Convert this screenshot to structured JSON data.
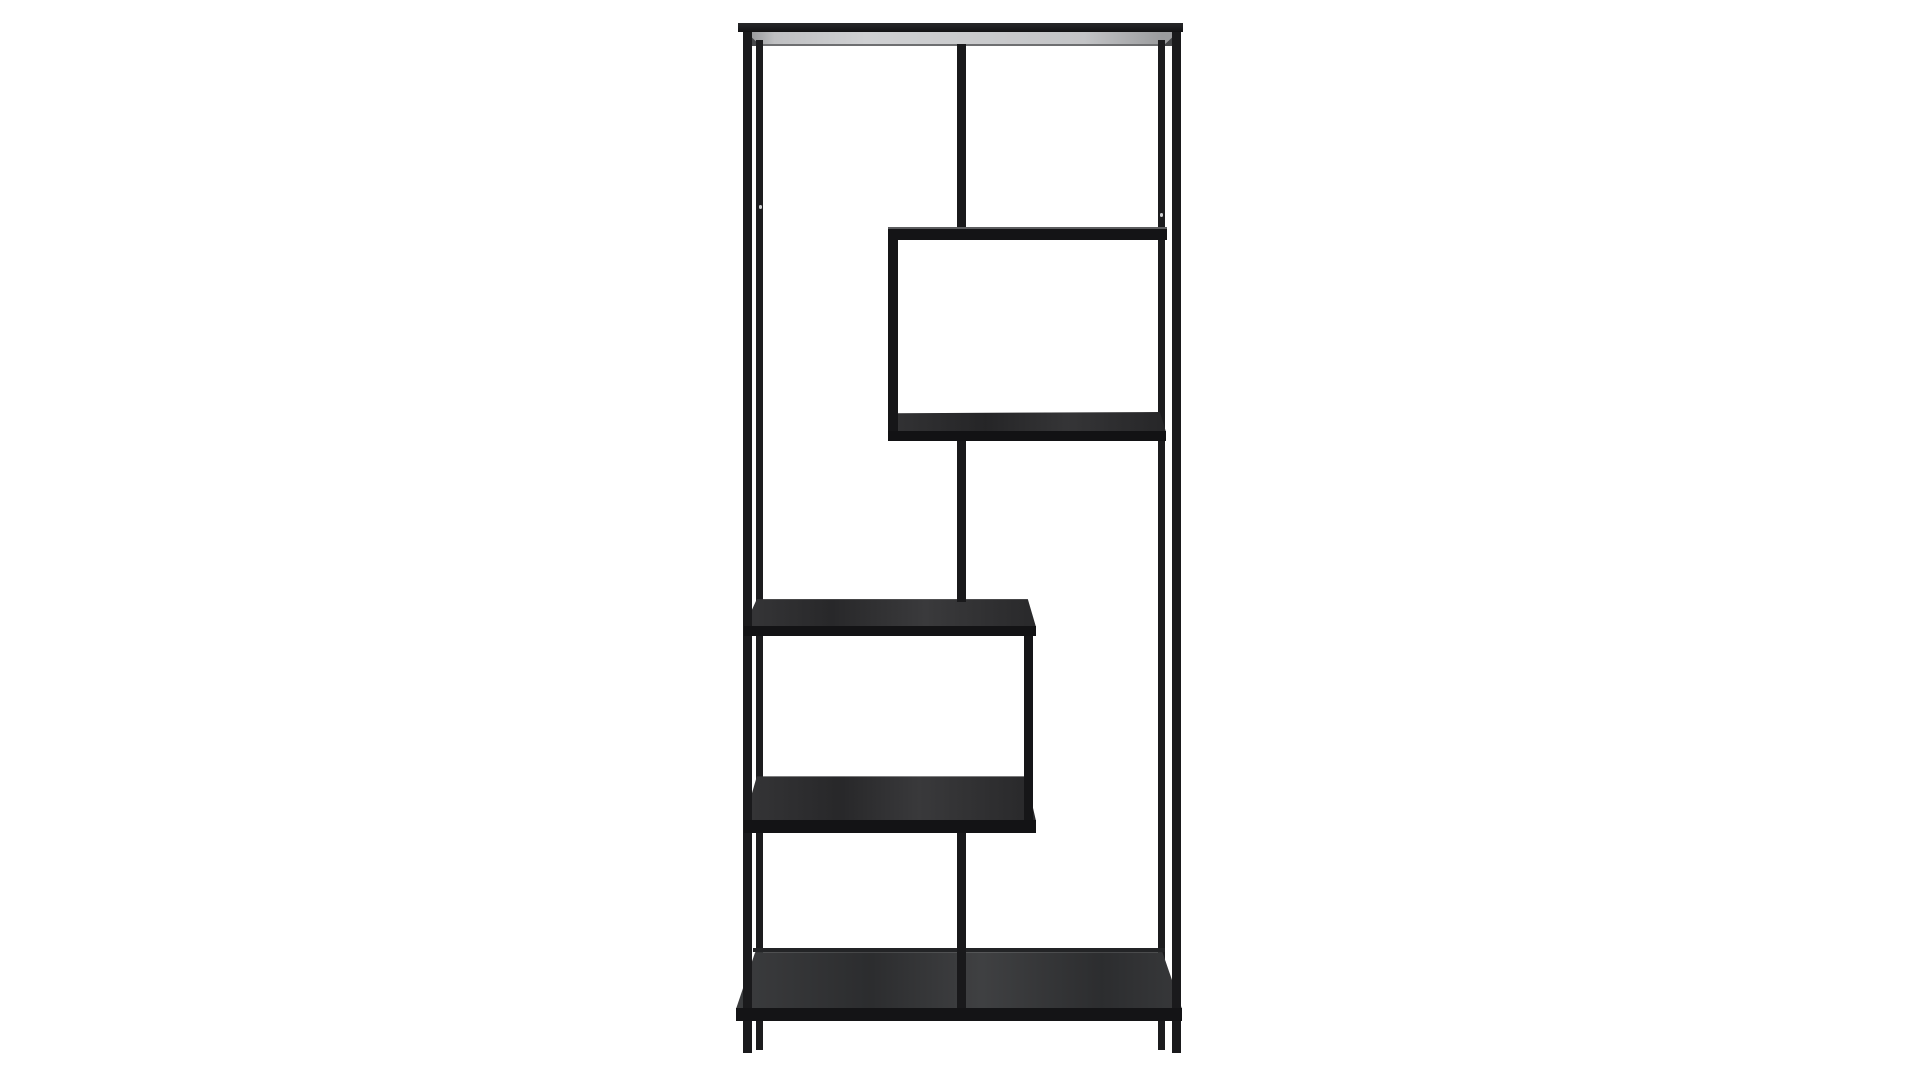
{
  "scene": {
    "description": "Product photo of a tall black metal asymmetric etagere bookcase with zig-zag open shelves, centered on a plain white studio background",
    "object": "asymmetric-metal-bookcase",
    "canvas": {
      "width": 1920,
      "height": 1080,
      "background": "#ffffff"
    },
    "palette": {
      "frame_metal": "#1a1a1c",
      "shelf_wood_top": "#2b2b2d",
      "top_shelf_underside": "#c9cacc",
      "background": "#ffffff"
    },
    "elements": [
      {
        "name": "top-shelf-underside",
        "x": 744,
        "y": 32,
        "w": 436,
        "h": 14,
        "bg": "linear-gradient(90deg,#8f9092 0%,#bfc0c2 7%,#cfd0d2 28%,#c9cacc 55%,#c3c4c6 78%,#9b9c9e 96%)",
        "clip": "polygon(0% 0%,100% 0%,96.3% 100%,3.2% 100%)"
      },
      {
        "name": "top-shelf-back-bar-line",
        "x": 757,
        "y": 44,
        "w": 408,
        "h": 2,
        "bg": "#6e6f71"
      },
      {
        "name": "top-shelf-left-corner-wedge",
        "x": 746,
        "y": 32,
        "w": 15,
        "h": 14,
        "bg": "#47484a",
        "clip": "polygon(0% 0%,100% 100%,0% 100%)"
      },
      {
        "name": "top-shelf-right-corner-wedge",
        "x": 1163,
        "y": 32,
        "w": 15,
        "h": 14,
        "bg": "#47484a",
        "clip": "polygon(100% 0%,100% 100%,0% 100%)"
      },
      {
        "name": "back-left-post",
        "x": 756,
        "y": 40,
        "w": 7,
        "h": 1010,
        "bg": "#1c1c1e"
      },
      {
        "name": "back-right-post",
        "x": 1158,
        "y": 40,
        "w": 7,
        "h": 1010,
        "bg": "#1c1c1e"
      },
      {
        "name": "box-bottom-shelf-surface",
        "x": 888,
        "y": 412,
        "w": 278,
        "h": 20,
        "bg": "linear-gradient(90deg,rgba(255,255,255,0.05),rgba(0,0,0,0.07) 35%,rgba(255,255,255,0.06) 65%,rgba(0,0,0,0.05)) #28282a",
        "clip": "polygon(2.5% 6%,97.8% 0%,100% 100%,0% 100%)"
      },
      {
        "name": "middle-left-shelf-surface",
        "x": 744,
        "y": 598,
        "w": 292,
        "h": 29,
        "bg": "linear-gradient(90deg,rgba(255,255,255,0.05),rgba(0,0,0,0.07) 30%,rgba(255,255,255,0.07) 62%,rgba(0,0,0,0.05)) #2b2b2d",
        "clip": "polygon(4.4% 4%,97.2% 4%,100% 100%,0% 100%)"
      },
      {
        "name": "lower-left-shelf-surface",
        "x": 744,
        "y": 775,
        "w": 292,
        "h": 46,
        "bg": "linear-gradient(90deg,rgba(255,255,255,0.05),rgba(0,0,0,0.06) 33%,rgba(255,255,255,0.07) 60%,rgba(0,0,0,0.05)) #2a2a2c",
        "clip": "polygon(4.4% 3%,96.5% 3%,100% 100%,0% 100%)"
      },
      {
        "name": "bottom-shelf-back-bar-line",
        "x": 753,
        "y": 948,
        "w": 412,
        "h": 4,
        "bg": "#232426"
      },
      {
        "name": "bottom-shelf-surface",
        "x": 736,
        "y": 951,
        "w": 446,
        "h": 58,
        "bg": "linear-gradient(90deg,rgba(255,255,255,0.06),rgba(0,0,0,0.07) 30%,rgba(255,255,255,0.08) 55%,rgba(0,0,0,0.06) 82%,rgba(255,255,255,0.04)) #2f3032",
        "clip": "polygon(4.3% 2%,95.6% 2%,100% 100%,0% 100%)"
      },
      {
        "name": "front-left-post",
        "x": 743,
        "y": 23,
        "w": 9,
        "h": 1030,
        "bg": "#1a1a1c"
      },
      {
        "name": "front-right-post",
        "x": 1172,
        "y": 23,
        "w": 9,
        "h": 1030,
        "bg": "#1a1a1c"
      },
      {
        "name": "center-divider-upper",
        "x": 957,
        "y": 44,
        "w": 9,
        "h": 186,
        "bg": "#19191b"
      },
      {
        "name": "center-divider-middle",
        "x": 957,
        "y": 438,
        "w": 9,
        "h": 164,
        "bg": "#19191b"
      },
      {
        "name": "center-divider-lower",
        "x": 957,
        "y": 828,
        "w": 9,
        "h": 186,
        "bg": "#19191b"
      },
      {
        "name": "box-left-edge-bar",
        "x": 888,
        "y": 230,
        "w": 10,
        "h": 204,
        "bg": "#161618"
      },
      {
        "name": "step-right-vertical-bar",
        "x": 1024,
        "y": 630,
        "w": 9,
        "h": 198,
        "bg": "#161618"
      },
      {
        "name": "screw-hole-dot-left",
        "x": 759,
        "y": 205,
        "w": 3,
        "h": 4,
        "bg": "#cfd0d2",
        "r": 2
      },
      {
        "name": "screw-hole-dot-right",
        "x": 1160,
        "y": 213,
        "w": 3,
        "h": 4,
        "bg": "#cfd0d2",
        "r": 2
      },
      {
        "name": "upper-right-shelf-bar",
        "x": 888,
        "y": 227,
        "w": 279,
        "h": 13,
        "bg": "linear-gradient(#5c5d5f 0px,#5c5d5f 2px,#141416 2px)"
      },
      {
        "name": "box-bottom-shelf-front-bar",
        "x": 888,
        "y": 431,
        "w": 278,
        "h": 10,
        "bg": "#121214"
      },
      {
        "name": "middle-left-shelf-front-bar",
        "x": 744,
        "y": 626,
        "w": 292,
        "h": 10,
        "bg": "#131315"
      },
      {
        "name": "lower-left-shelf-front-bar",
        "x": 744,
        "y": 820,
        "w": 292,
        "h": 13,
        "bg": "#131315"
      },
      {
        "name": "bottom-shelf-front-bar",
        "x": 736,
        "y": 1008,
        "w": 446,
        "h": 13,
        "bg": "#141416"
      },
      {
        "name": "top-shelf-front-bar",
        "x": 738,
        "y": 23,
        "w": 445,
        "h": 9,
        "bg": "linear-gradient(#27282a,#121214)"
      }
    ]
  }
}
